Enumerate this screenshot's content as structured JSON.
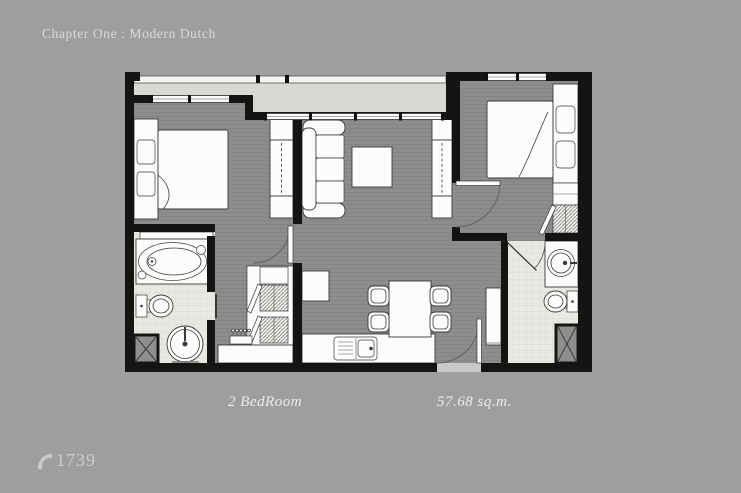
{
  "header": {
    "title": "Chapter One : Modern Dutch"
  },
  "floorplan": {
    "labels": {
      "unit_type": "2 BedRoom",
      "area": "57.68 sq.m."
    },
    "colors": {
      "background": "#9e9e9c",
      "wall": "#141413",
      "room_floor": "#8d8d8c",
      "balcony_floor": "#d8d8d5",
      "tile_floor": "#eae8e2",
      "furniture": "#fcfcfb",
      "caption_text": "#d9d9d7",
      "label_text": "#ebebe9"
    },
    "rooms": [
      "balcony",
      "bedroom-1",
      "living-room",
      "bedroom-2",
      "bathroom-1",
      "walk-in-closet",
      "kitchen-dining",
      "entrance-foyer",
      "bathroom-2"
    ]
  },
  "footer": {
    "phone_number": "1739"
  }
}
